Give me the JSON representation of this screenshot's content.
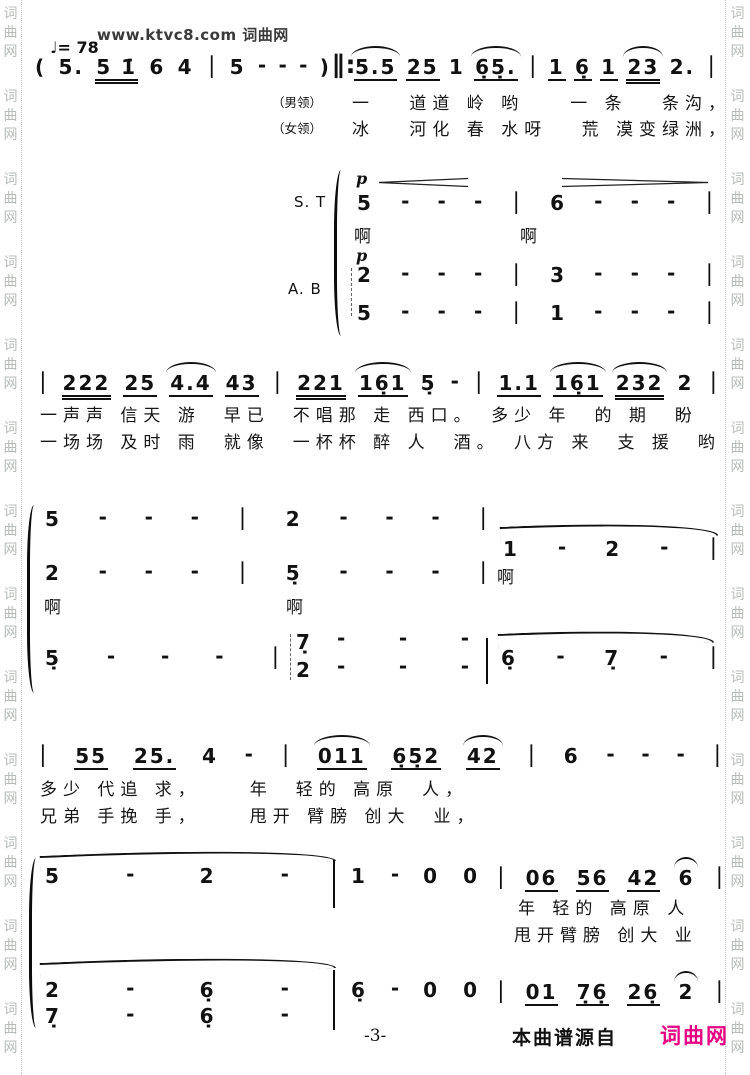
{
  "branding": {
    "logo": "www.ktvc8.com 词曲网",
    "side_watermark": "词曲网"
  },
  "tempo": "♩= 78",
  "s1": {
    "intro": [
      {
        "t": "("
      },
      {
        "t": "5."
      },
      {
        "t": "5 1̇",
        "u": 2
      },
      {
        "t": "6"
      },
      {
        "t": "4"
      },
      {
        "t": "∣"
      },
      {
        "t": "5"
      },
      {
        "t": "-"
      },
      {
        "t": "-"
      },
      {
        "t": "-"
      },
      {
        "t": ")"
      }
    ],
    "repeat": "∥:",
    "melody": [
      {
        "t": "5.5",
        "u": 1,
        "s": 1
      },
      {
        "t": "25",
        "u": 1
      },
      {
        "t": "1"
      },
      {
        "t": "6̣5̣.",
        "u": 1,
        "s": 1
      },
      {
        "t": "∣"
      },
      {
        "t": "1",
        "u": 1
      },
      {
        "t": "6̣",
        "u": 1
      },
      {
        "t": "1",
        "u": 1
      },
      {
        "t": "23",
        "u": 2,
        "s": 1
      },
      {
        "t": "2."
      },
      {
        "t": "∣"
      }
    ],
    "role_male": "（男领）",
    "role_female": "（女领）",
    "lyrics_male": "一　 道道 岭 哟　　一 条　 条沟，",
    "lyrics_female": "冰　 河化 春 水呀　 荒 漠变绿洲，"
  },
  "s2": {
    "label_st": "S. T",
    "label_ab": "A. B",
    "dyn": "p",
    "st_notes": [
      {
        "t": "5"
      },
      {
        "t": "-"
      },
      {
        "t": "-"
      },
      {
        "t": "-"
      },
      {
        "t": "∣"
      },
      {
        "t": "6"
      },
      {
        "t": "-"
      },
      {
        "t": "-"
      },
      {
        "t": "-"
      },
      {
        "t": "∣"
      }
    ],
    "ah1": "啊",
    "ah2": "啊",
    "ab_notes_top": [
      {
        "t": "2"
      },
      {
        "t": "-"
      },
      {
        "t": "-"
      },
      {
        "t": "-"
      },
      {
        "t": "∣"
      },
      {
        "t": "3"
      },
      {
        "t": "-"
      },
      {
        "t": "-"
      },
      {
        "t": "-"
      },
      {
        "t": "∣"
      }
    ],
    "ab_notes_bottom": [
      {
        "t": "5"
      },
      {
        "t": "-"
      },
      {
        "t": "-"
      },
      {
        "t": "-"
      },
      {
        "t": "∣"
      },
      {
        "t": "1"
      },
      {
        "t": "-"
      },
      {
        "t": "-"
      },
      {
        "t": "-"
      },
      {
        "t": "∣"
      }
    ]
  },
  "s3": {
    "notes": [
      {
        "t": "∣"
      },
      {
        "t": "222",
        "u": 2
      },
      {
        "t": "25",
        "u": 1
      },
      {
        "t": "4.4",
        "u": 1,
        "s": 1
      },
      {
        "t": "43",
        "u": 1
      },
      {
        "t": "∣"
      },
      {
        "t": "221",
        "u": 2
      },
      {
        "t": "16̣1",
        "u": 1,
        "s": 1
      },
      {
        "t": "5̣"
      },
      {
        "t": "-"
      },
      {
        "t": "∣"
      },
      {
        "t": "1.1",
        "u": 1
      },
      {
        "t": "16̣1",
        "u": 1,
        "s": 1
      },
      {
        "t": "232",
        "u": 2,
        "s": 1
      },
      {
        "t": "2"
      },
      {
        "t": "∣"
      }
    ],
    "lyrics1": "一声声 信天 游　早已　不唱那 走 西口。　多少 年　的 期　盼",
    "lyrics2": "一场场 及时 雨　就像　一杯杯 醉 人　酒。　八方 来　支 援　哟"
  },
  "s4": {
    "row1": [
      {
        "t": "5"
      },
      {
        "t": "-"
      },
      {
        "t": "-"
      },
      {
        "t": "-"
      },
      {
        "t": "∣"
      },
      {
        "t": "2"
      },
      {
        "t": "-"
      },
      {
        "t": "-"
      },
      {
        "t": "-"
      },
      {
        "t": "∣"
      }
    ],
    "row1b": [
      {
        "t": "1"
      },
      {
        "t": "-"
      },
      {
        "t": "2"
      },
      {
        "t": "-"
      },
      {
        "t": "∣"
      }
    ],
    "row1b_lyric": "啊",
    "row2": [
      {
        "t": "2"
      },
      {
        "t": "-"
      },
      {
        "t": "-"
      },
      {
        "t": "-"
      },
      {
        "t": "∣"
      },
      {
        "t": "5̣"
      },
      {
        "t": "-"
      },
      {
        "t": "-"
      },
      {
        "t": "-"
      },
      {
        "t": "∣"
      }
    ],
    "row2_lyric1": "啊",
    "row2_lyric2": "啊",
    "bass_left": [
      {
        "t": "5̣"
      },
      {
        "t": "-"
      },
      {
        "t": "-"
      },
      {
        "t": "-"
      },
      {
        "t": "∣"
      }
    ],
    "chord_top": "7̣",
    "chord_bottom": "2",
    "bass_dash_top": [
      {
        "t": "-"
      },
      {
        "t": "-"
      },
      {
        "t": "-"
      }
    ],
    "bass_dash_bottom": [
      {
        "t": "-"
      },
      {
        "t": "-"
      },
      {
        "t": "-"
      }
    ],
    "bass_right": [
      {
        "t": "6̣"
      },
      {
        "t": "-"
      },
      {
        "t": "7̣"
      },
      {
        "t": "-"
      },
      {
        "t": "∣"
      }
    ]
  },
  "s5": {
    "notes": [
      {
        "t": "∣"
      },
      {
        "t": "55",
        "u": 1
      },
      {
        "t": "25.",
        "u": 1
      },
      {
        "t": "4"
      },
      {
        "t": "-"
      },
      {
        "t": "∣"
      },
      {
        "t": "011",
        "u": 1,
        "s": 1
      },
      {
        "t": "6̣5̣2",
        "u": 1
      },
      {
        "t": "42",
        "u": 1,
        "s": 1
      },
      {
        "t": "∣"
      },
      {
        "t": "6"
      },
      {
        "t": "-"
      },
      {
        "t": "-"
      },
      {
        "t": "-"
      },
      {
        "t": "∣"
      }
    ],
    "lyrics1": "多少 代追 求，　　 年　轻的 高原　人，",
    "lyrics2": "兄弟 手挽 手，　　 甩开 臂膀 创大　业，"
  },
  "s6": {
    "row1_m1": [
      {
        "t": "5"
      },
      {
        "t": "-"
      },
      {
        "t": "2"
      },
      {
        "t": "-"
      }
    ],
    "row1_m2": [
      {
        "t": "1"
      },
      {
        "t": "-"
      },
      {
        "t": "0"
      },
      {
        "t": "0"
      }
    ],
    "row1_right": [
      {
        "t": "∣"
      },
      {
        "t": "06",
        "u": 1
      },
      {
        "t": "56",
        "u": 1
      },
      {
        "t": "42",
        "u": 1
      },
      {
        "t": "6",
        "s": 1
      },
      {
        "t": "∣"
      }
    ],
    "lyrics1": "年 轻的 高原 人",
    "lyrics2": "甩开臂膀 创大 业",
    "row2_top": [
      {
        "t": "2"
      },
      {
        "t": "-"
      },
      {
        "t": "6̣"
      },
      {
        "t": "-"
      }
    ],
    "row2_mid": [
      {
        "t": "6̣"
      },
      {
        "t": "-"
      },
      {
        "t": "0"
      },
      {
        "t": "0"
      }
    ],
    "row2_right": [
      {
        "t": "∣"
      },
      {
        "t": "01",
        "u": 1
      },
      {
        "t": "7̣6̣",
        "u": 1
      },
      {
        "t": "26̣",
        "u": 1
      },
      {
        "t": "2",
        "s": 1
      },
      {
        "t": "∣"
      }
    ],
    "row2_bottom": [
      {
        "t": "7̣"
      },
      {
        "t": "-"
      },
      {
        "t": "6̣"
      },
      {
        "t": "-"
      }
    ]
  },
  "footer": {
    "page_number": "-3-",
    "source_text": "本曲谱源自",
    "brand": "词曲网",
    "brand_color": "#e60082"
  }
}
